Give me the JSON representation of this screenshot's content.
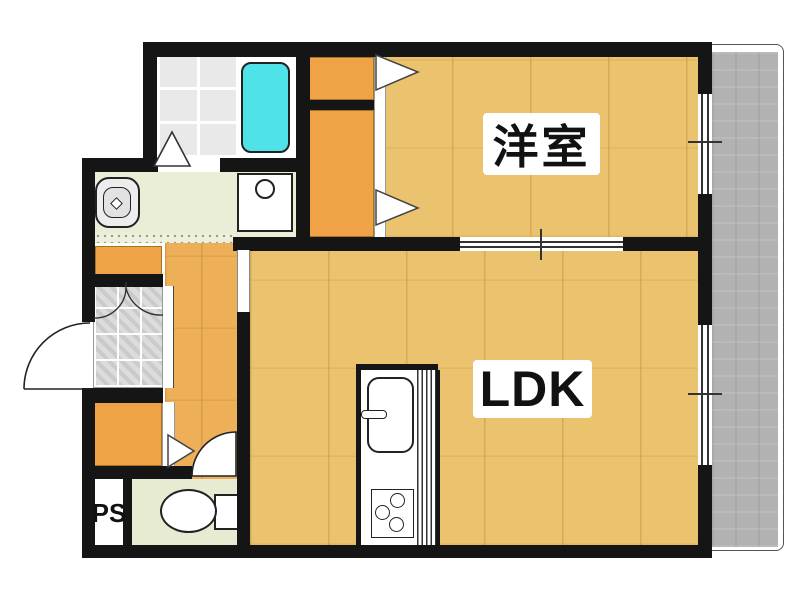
{
  "title": "apartment floor plan",
  "rooms": {
    "western_room": {
      "label": "洋室"
    },
    "ldk": {
      "label": "LDK"
    },
    "pipe_space": {
      "label": "PS"
    }
  },
  "fixtures": [
    "bathtub",
    "washing-machine-pan",
    "washroom-sink",
    "toilet",
    "kitchen-sink",
    "kitchen-stove",
    "entrance-door",
    "toilet-door",
    "closets",
    "balcony"
  ],
  "colors": {
    "wall": "#151515",
    "wood_floor": "#ebc26d",
    "hall_wood_floor": "#edb058",
    "bathtub": "#4fe3e8",
    "closet_orange": "#f0a247",
    "balcony_gray": "#b2b2b2",
    "washroom_floor": "#eaeed6",
    "toilet_floor": "#e7ebd1",
    "bath_tile": "#e9e9e9",
    "label_text": "#111111",
    "label_bg": "#ffffff"
  }
}
